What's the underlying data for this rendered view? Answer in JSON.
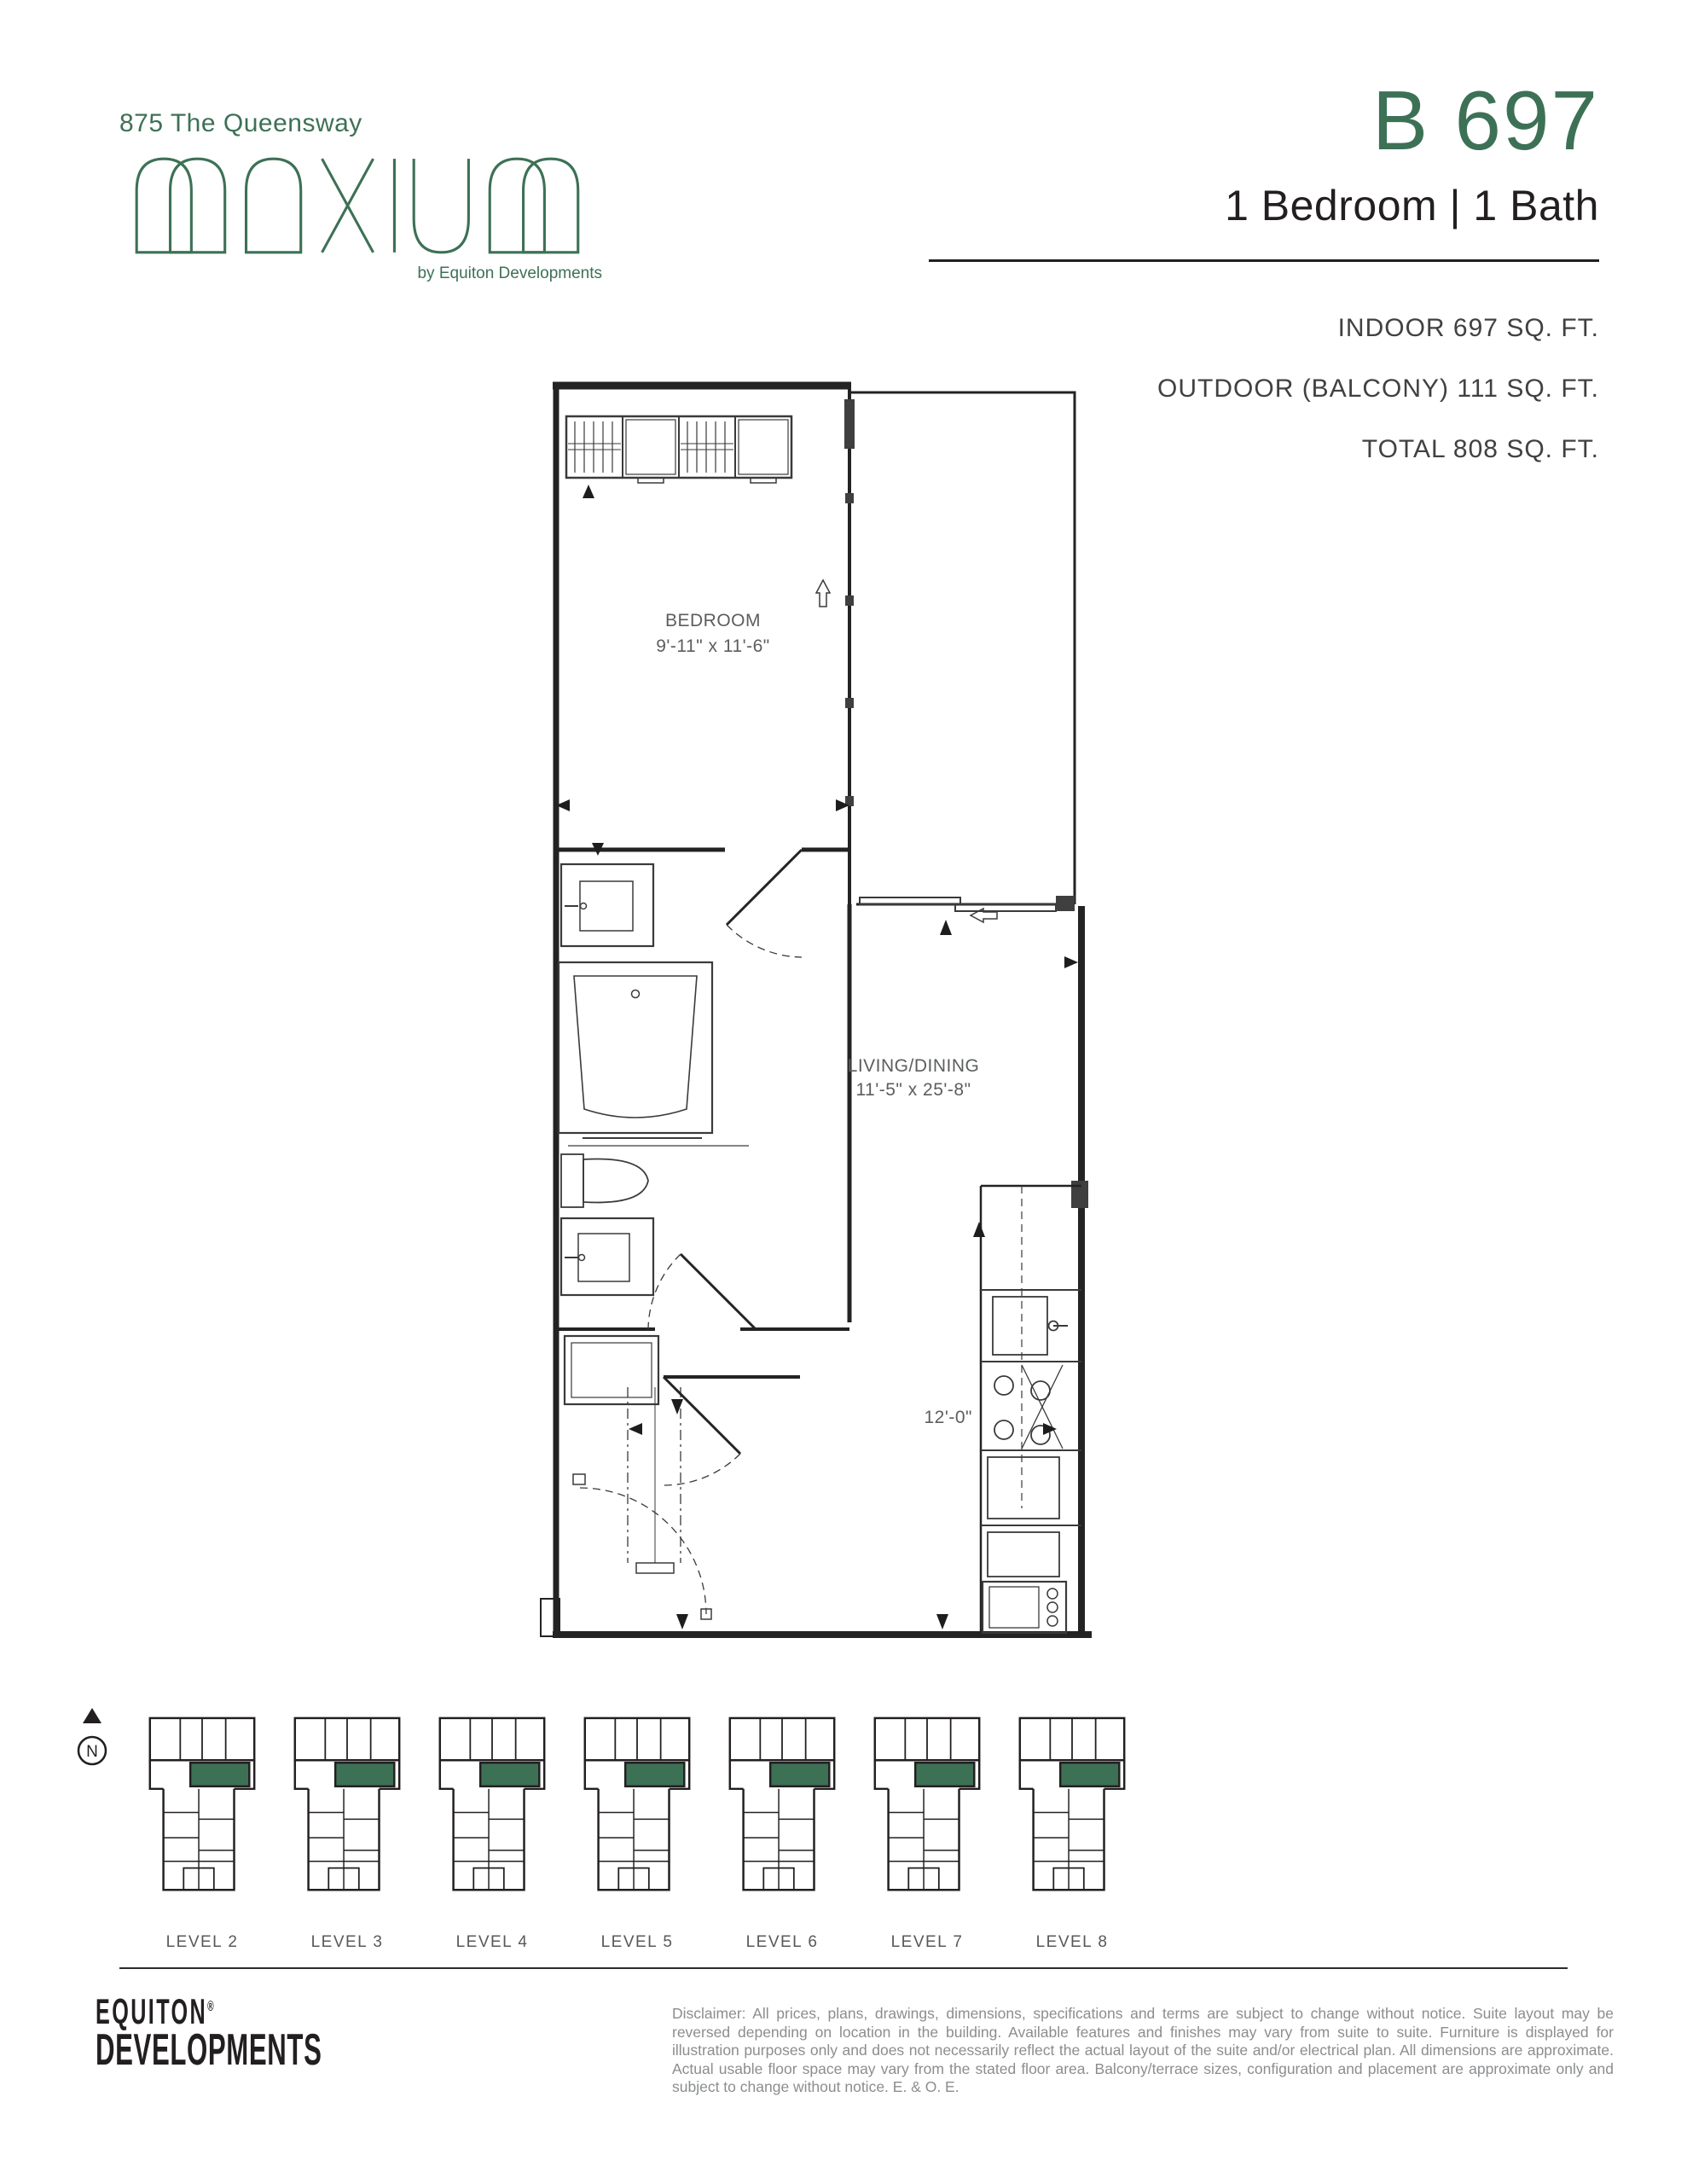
{
  "header": {
    "address": "875 The Queensway",
    "logo_name": "MAXIUM",
    "logo_byline": "by Equiton Developments",
    "unit_number": "B 697",
    "unit_type": "1 Bedroom | 1 Bath",
    "areas": {
      "indoor": "INDOOR 697 SQ. FT.",
      "outdoor": "OUTDOOR (BALCONY) 111 SQ. FT.",
      "total": "TOTAL 808 SQ. FT."
    }
  },
  "floorplan": {
    "rooms": [
      {
        "name": "BEDROOM",
        "dims": "9'-11\" x 11'-6\""
      },
      {
        "name": "LIVING/DINING",
        "dims": "11'-5\" x 25'-8\""
      }
    ],
    "kitchen_dim": "12'-0\"",
    "compass_n": "N"
  },
  "keyplans": {
    "levels": [
      {
        "label": "LEVEL 2"
      },
      {
        "label": "LEVEL 3"
      },
      {
        "label": "LEVEL 4"
      },
      {
        "label": "LEVEL 5"
      },
      {
        "label": "LEVEL 6"
      },
      {
        "label": "LEVEL 7"
      },
      {
        "label": "LEVEL 8"
      }
    ]
  },
  "footer": {
    "logo_line1": "EQUITON",
    "logo_reg": "®",
    "logo_line2": "DEVELOPMENTS",
    "disclaimer": "Disclaimer: All prices, plans, drawings, dimensions, specifications and terms are subject to change without notice. Suite layout may be reversed depending on location in the building. Available features and finishes may vary from suite to suite. Furniture is displayed for illustration purposes only and does not necessarily reflect the actual layout of the suite and/or electrical plan. All dimensions are approximate. Actual usable floor space may vary from the stated floor area. Balcony/terrace sizes, configuration and placement are approximate only and subject to change without notice. E. & O. E."
  },
  "colors": {
    "brand_green": "#3d7156",
    "ink": "#231f20",
    "label_gray": "#58595b",
    "disclaimer_gray": "#8b8d8f"
  }
}
